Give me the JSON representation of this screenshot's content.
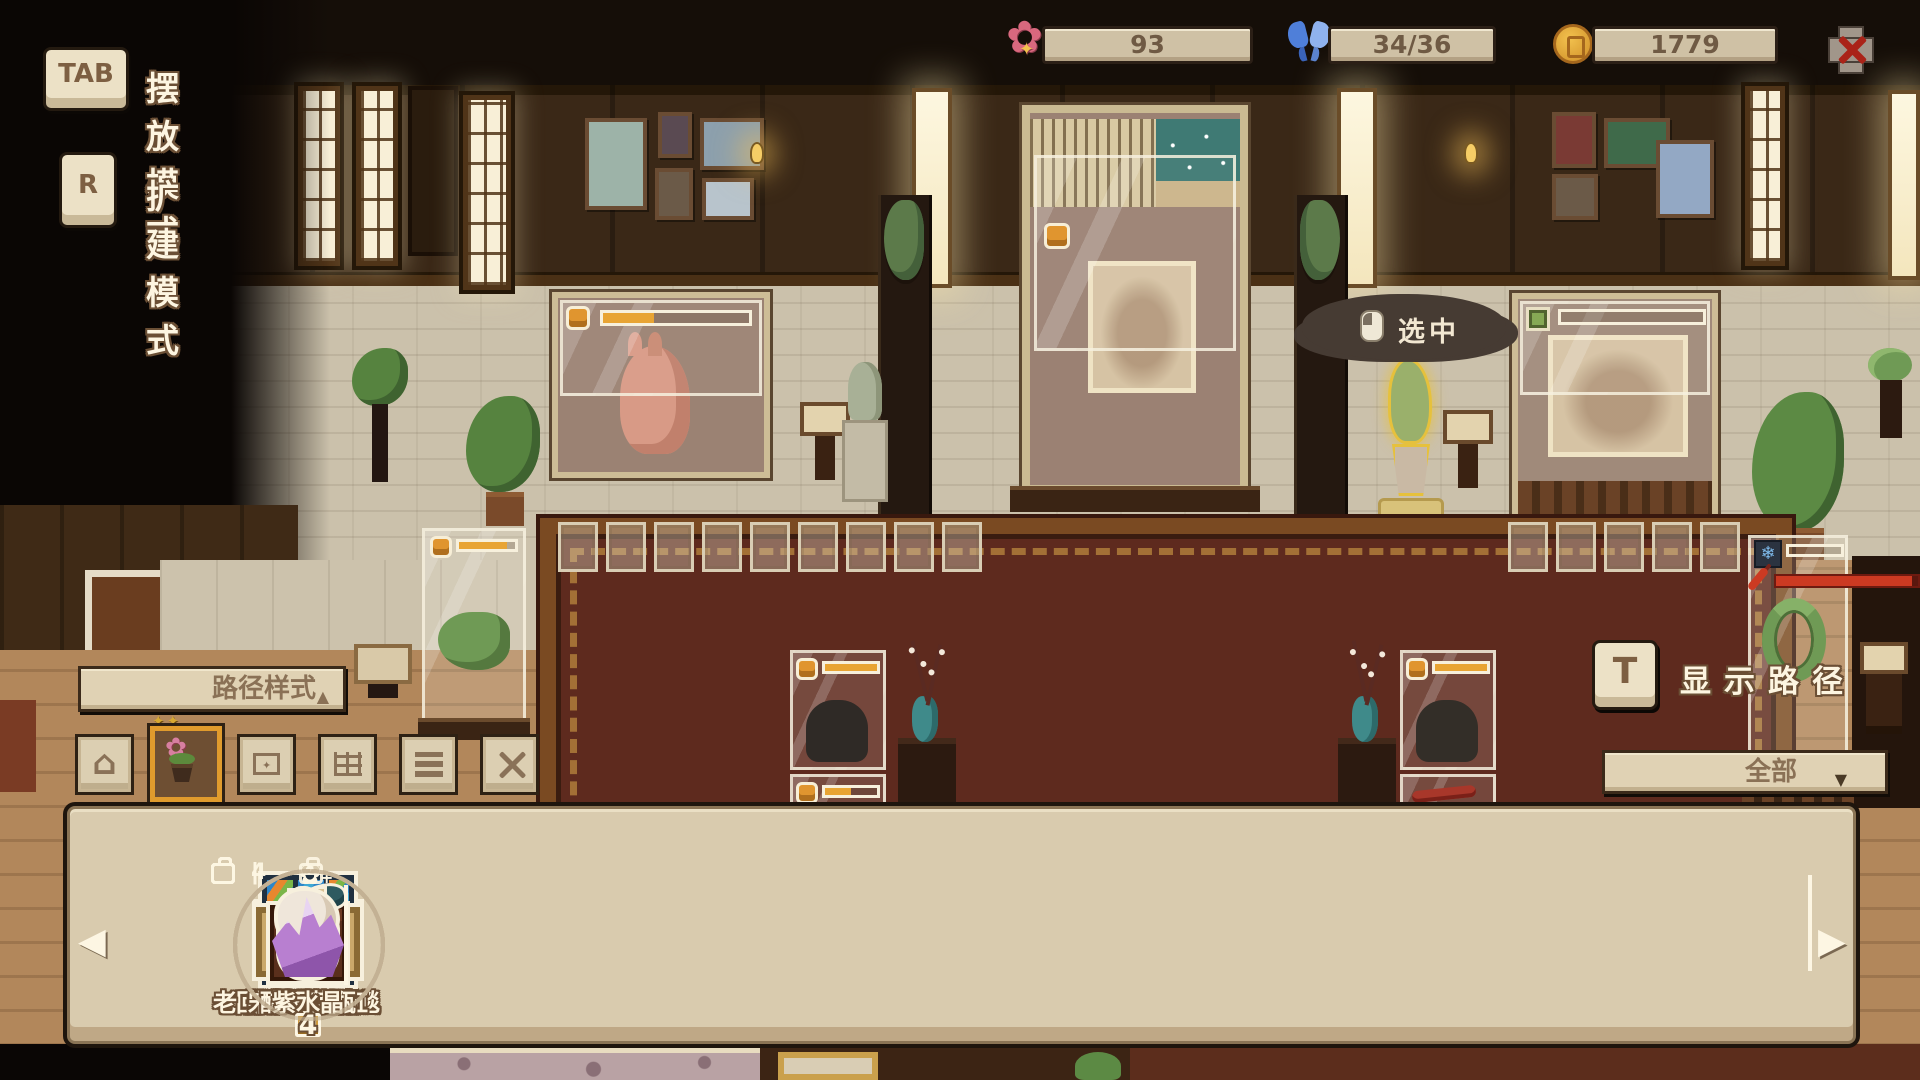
{
  "hud": {
    "modes": [
      {
        "key": "TAB",
        "label": "摆放模式"
      },
      {
        "key": "R",
        "label": "扩建模式"
      }
    ],
    "resources": [
      {
        "icon": "flower-icon",
        "value": "93"
      },
      {
        "icon": "butterfly-icon",
        "value": "34/36"
      },
      {
        "icon": "coin-icon",
        "value": "1779"
      }
    ],
    "tooltip": {
      "icon": "mouse-icon",
      "text": "选中"
    },
    "path_style": {
      "label": "路径样式",
      "arrow": "▲"
    },
    "categories": [
      {
        "icon": "house-icon",
        "selected": false
      },
      {
        "icon": "plant-icon",
        "selected": true
      },
      {
        "icon": "frame-icon",
        "selected": false
      },
      {
        "icon": "bricks-icon",
        "selected": false
      },
      {
        "icon": "flooring-icon",
        "selected": false
      },
      {
        "icon": "tools-icon",
        "selected": false
      }
    ],
    "show_path": {
      "key": "T",
      "label": "显示路径"
    },
    "filter": {
      "value": "全部",
      "arrow": "▼"
    },
    "item_bar": {
      "prev_arrow": "◀",
      "next_arrow": "▶",
      "items": [
        {
          "name": "夜以继日桌",
          "count": "4",
          "icon": "desk",
          "badges": [
            "bag",
            "|",
            "flower"
          ]
        },
        {
          "name": "摩登拼色屏风",
          "count": "4",
          "icon": "screen",
          "badges": [
            "bag",
            "|",
            "flower"
          ]
        },
        {
          "name": "红柳木边柜",
          "count": "4",
          "icon": "cabinet",
          "badges": [
            "bag",
            "|",
            "flower"
          ]
        },
        {
          "name": "回纹编织地毯",
          "count": "4",
          "icon": "rug",
          "badges": [
            "bag",
            "|",
            "flower"
          ]
        },
        {
          "name": "接待员木柜",
          "count": "4",
          "icon": "drawers",
          "badges": [
            "bag",
            "|",
            "flower"
          ]
        },
        {
          "name": "宋式书画缸",
          "count": "4",
          "icon": "jar",
          "badges": [
            "bag",
            "|",
            "flower"
          ]
        },
        {
          "name": "醋栗花瓶",
          "count": "4",
          "icon": "vase",
          "badges": [
            "bag",
            "|",
            "bag-plus"
          ]
        },
        {
          "name": "紫水晶",
          "count": "4",
          "icon": "crystal",
          "badges": [
            "bag",
            "4",
            "heart"
          ]
        },
        {
          "name": "老",
          "count": "",
          "icon": "partial",
          "badges": [
            "bag"
          ]
        }
      ]
    }
  },
  "scene": {
    "case_bars": {
      "horse_case": 35,
      "fish_case": 85,
      "mid_left_top": 100,
      "mid_left_bottom": 50,
      "mid_right_top": 100,
      "mid_right_bottom": 50,
      "relief_case": 0,
      "eel_case": 0,
      "eel_red_bar": 96
    }
  },
  "colors": {
    "accent_gold": "#e8a433",
    "selected_orange": "#e09b2d",
    "alert_red": "#cc3a22",
    "hud_cream": "#d9cbae"
  }
}
